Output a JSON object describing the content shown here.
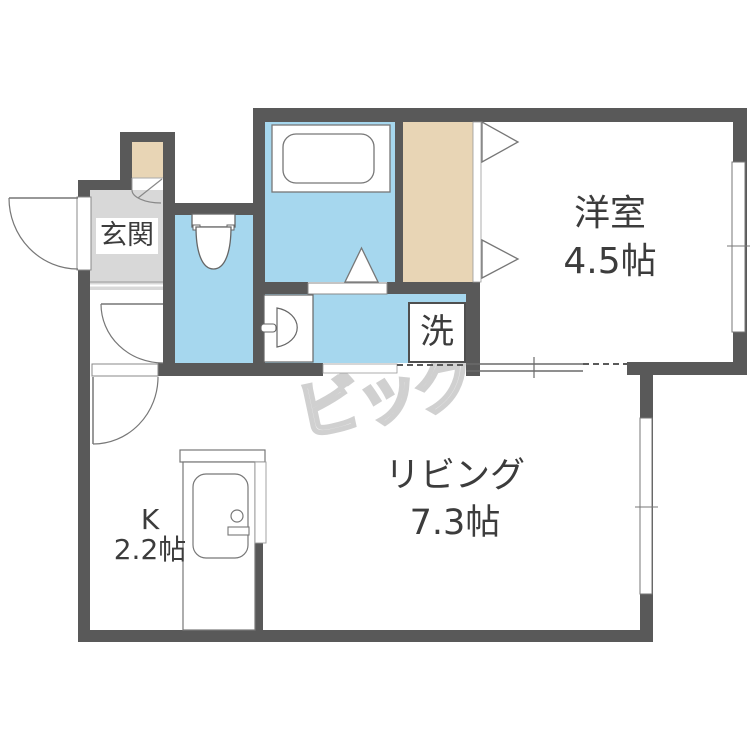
{
  "colors": {
    "bg": "#ffffff",
    "wall": "#595959",
    "water": "#a6d7ee",
    "tan": "#e8d5b5",
    "genkan": "#d8d8d8",
    "line": "#707070",
    "text": "#3c3c3c",
    "watermark": "#ececec"
  },
  "rooms": {
    "genkan": {
      "label": "玄関"
    },
    "western": {
      "label": "洋室",
      "size": "4.5帖"
    },
    "living": {
      "label": "リビング",
      "size": "7.3帖"
    },
    "kitchen": {
      "label": "K",
      "size": "2.2帖"
    },
    "laundry": {
      "label": "洗"
    }
  },
  "watermark": {
    "text": "ビッグ"
  }
}
